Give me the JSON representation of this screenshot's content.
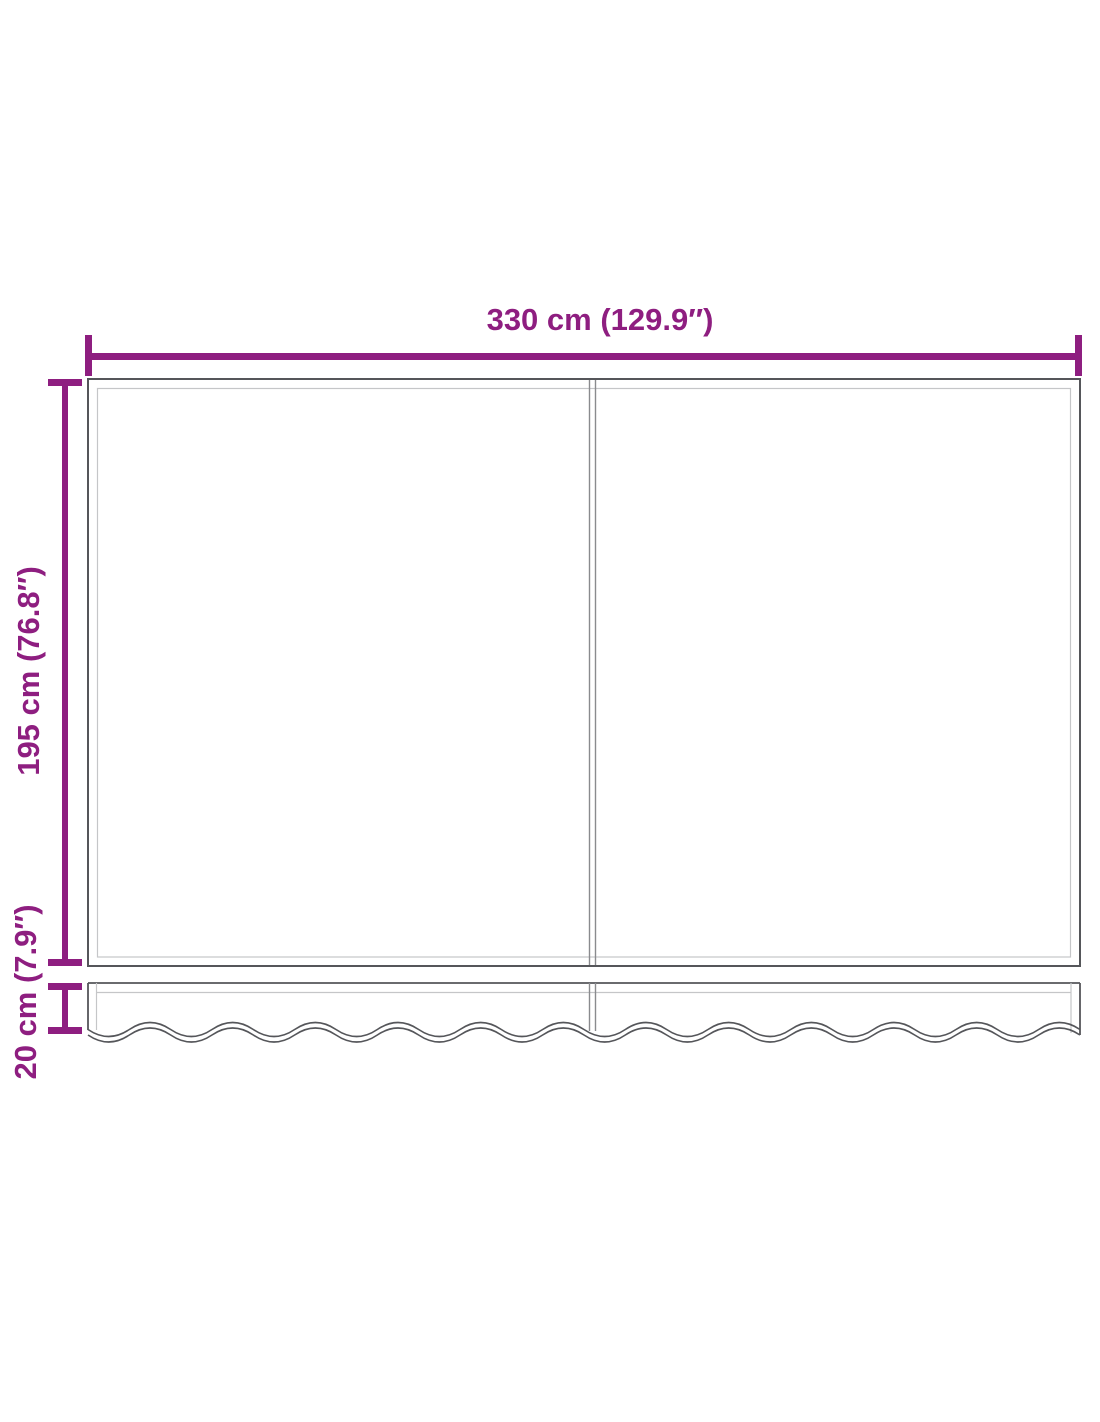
{
  "diagram": {
    "type": "product-dimension-diagram",
    "subject": "awning replacement fabric with scalloped valance, two panels",
    "background_color": "#ffffff",
    "accent_color": "#8E1E80",
    "outline_color": "#55565A",
    "seam_line_color": "#C5C6C8",
    "divider_line_color": "#8A8B8E",
    "labels": {
      "width": "330 cm (129.9″)",
      "height": "195 cm (76.8″)",
      "valance": "20 cm (7.9″)"
    }
  }
}
